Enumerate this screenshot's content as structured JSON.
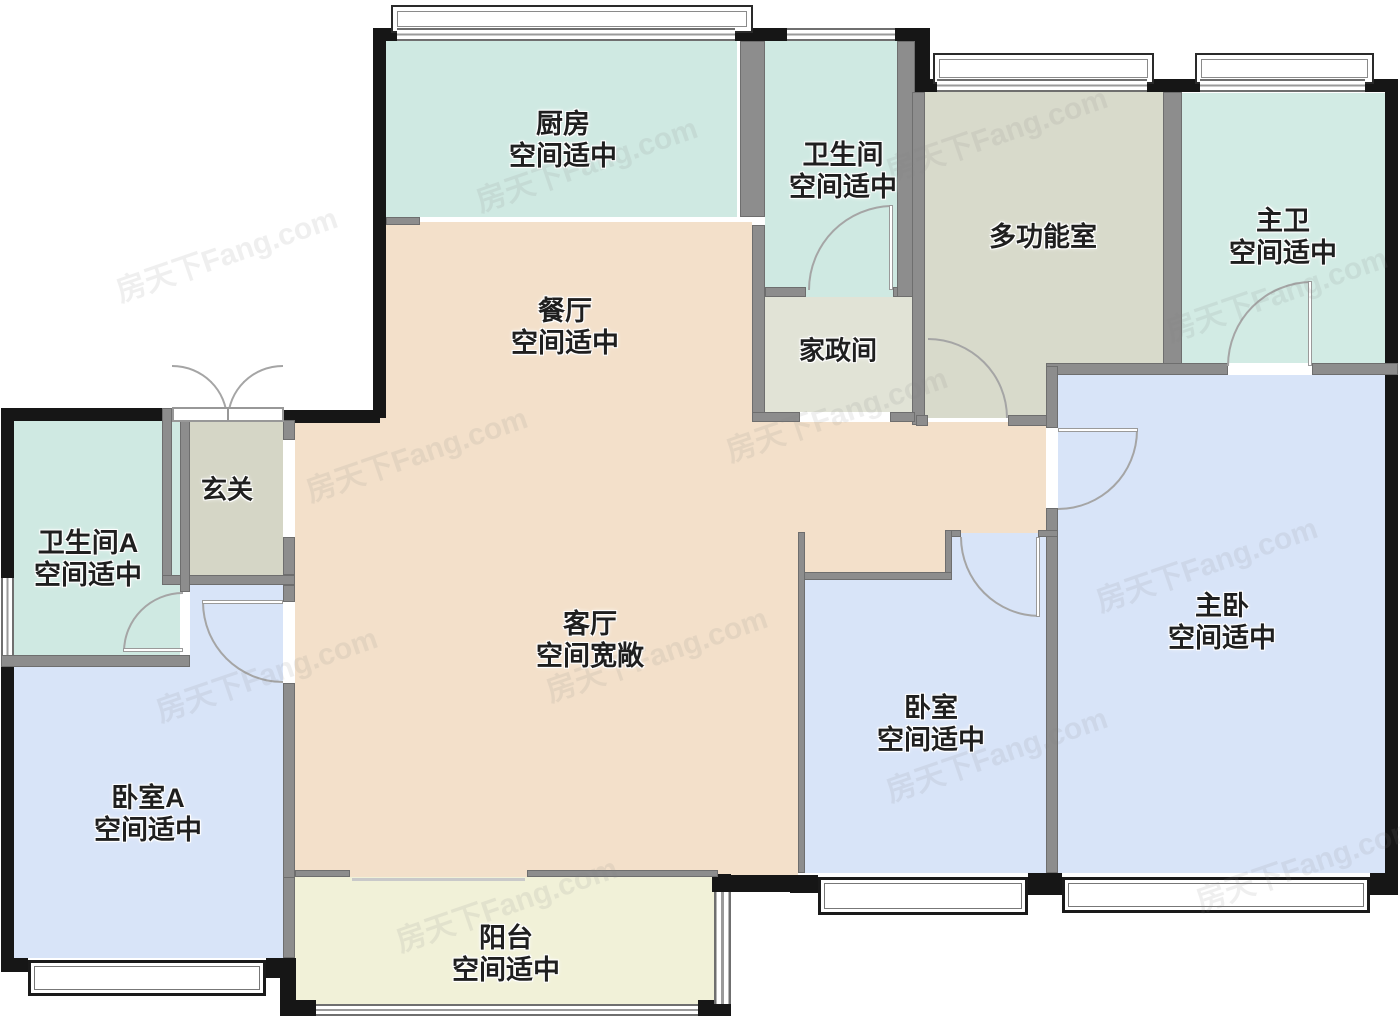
{
  "watermark": {
    "text": "房天下Fang.com"
  },
  "palette": {
    "dining_living_peach": "#f3e0ca",
    "kitchen_bath_mint": "#cfe9e2",
    "multi_room_gray": "#d8dacb",
    "housekeeping_gray": "#e1e3d6",
    "foyer_gray": "#d5d6c6",
    "bedroom_blue": "#d8e4f8",
    "balcony_cream": "#f1f1d8",
    "exterior_wall": "#161616",
    "interior_wall": "#8d8d8d"
  },
  "rooms": [
    {
      "id": "kitchen",
      "name": "厨房",
      "note": "空间适中"
    },
    {
      "id": "bathroom",
      "name": "卫生间",
      "note": "空间适中"
    },
    {
      "id": "multi-room",
      "name": "多功能室",
      "note": ""
    },
    {
      "id": "master-bath",
      "name": "主卫",
      "note": "空间适中"
    },
    {
      "id": "dining",
      "name": "餐厅",
      "note": "空间适中"
    },
    {
      "id": "housekeeping",
      "name": "家政间",
      "note": ""
    },
    {
      "id": "foyer",
      "name": "玄关",
      "note": ""
    },
    {
      "id": "bathroom-a",
      "name": "卫生间A",
      "note": "空间适中"
    },
    {
      "id": "living",
      "name": "客厅",
      "note": "空间宽敞"
    },
    {
      "id": "bedroom-a",
      "name": "卧室A",
      "note": "空间适中"
    },
    {
      "id": "bedroom",
      "name": "卧室",
      "note": "空间适中"
    },
    {
      "id": "master-bed",
      "name": "主卧",
      "note": "空间适中"
    },
    {
      "id": "balcony",
      "name": "阳台",
      "note": "空间适中"
    }
  ]
}
